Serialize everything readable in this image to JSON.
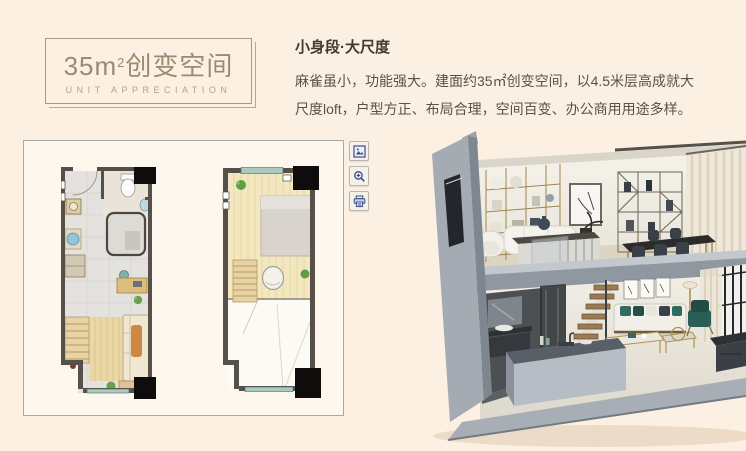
{
  "page": {
    "background": "#fcf0e2"
  },
  "title_card": {
    "area_value": "35m",
    "area_exponent": "2",
    "title_suffix": "创变空间",
    "subtitle": "UNIT APPRECIATION"
  },
  "intro": {
    "heading": "小身段·大尺度",
    "line1": "麻雀虽小，功能强大。建面约35㎡创变空间，以4.5米层高成就大",
    "line2": "尺度loft，户型方正、布局合理，空间百变、办公商用用途多样。"
  },
  "floorplan_viewer": {
    "plans": [
      {
        "id": "lower-floor-plan"
      },
      {
        "id": "upper-floor-plan"
      }
    ],
    "tools": [
      {
        "icon": "view-image-icon"
      },
      {
        "icon": "zoom-in-icon"
      },
      {
        "icon": "print-icon"
      }
    ]
  },
  "colors": {
    "accent_brown": "#9c8a72",
    "title_border": "#a89a82",
    "heading_text": "#3f3a33",
    "body_text": "#57534b",
    "panel_border": "#a9a8a0",
    "panel_bg": "#fdf7ee",
    "plan_wall": "#57504a",
    "plan_window_teal": "#a9cac1",
    "shell_gray": "#9aa2ab",
    "tool_icon_blue": "#3d4c85",
    "page_bg": "#fcf0e2"
  }
}
